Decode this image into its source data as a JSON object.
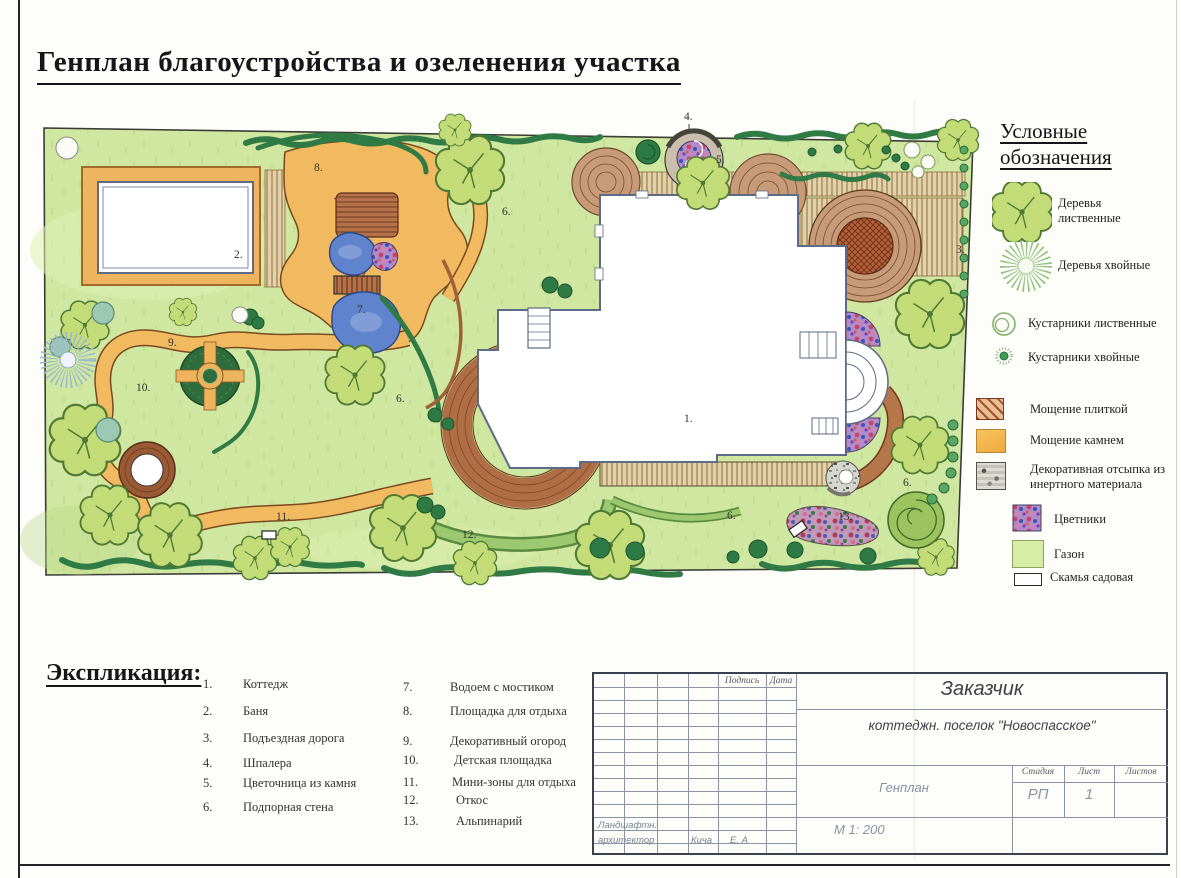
{
  "page": {
    "title": "Генплан благоустройства и озеленения участка"
  },
  "legend": {
    "heading_line1": "Условные",
    "heading_line2": "обозначения",
    "items": [
      {
        "icon": "deciduous-tree-icon",
        "label": "Деревья лиственные"
      },
      {
        "icon": "coniferous-tree-icon",
        "label": "Деревья хвойные"
      },
      {
        "icon": "deciduous-shrub-icon",
        "label": "Кустарники лиственные"
      },
      {
        "icon": "coniferous-shrub-icon",
        "label": "Кустарники хвойные"
      },
      {
        "icon": "tile-paving-swatch",
        "label": "Мощение плиткой"
      },
      {
        "icon": "stone-paving-swatch",
        "label": "Мощение камнем"
      },
      {
        "icon": "inert-fill-swatch",
        "label": "Декоративная отсыпка из инертного материала"
      },
      {
        "icon": "flowerbed-swatch",
        "label": "Цветники"
      },
      {
        "icon": "lawn-swatch",
        "label": "Газон"
      },
      {
        "icon": "garden-bench-icon",
        "label": "Скамья садовая"
      }
    ]
  },
  "explication": {
    "heading": "Экспликация:",
    "items": [
      {
        "num": "1.",
        "label": "Коттедж"
      },
      {
        "num": "2.",
        "label": "Баня"
      },
      {
        "num": "3.",
        "label": "Подъездная дорога"
      },
      {
        "num": "4.",
        "label": "Шпалера"
      },
      {
        "num": "5.",
        "label": "Цветочница из камня"
      },
      {
        "num": "6.",
        "label": "Подпорная стена"
      },
      {
        "num": "7.",
        "label": "Водоем с мостиком"
      },
      {
        "num": "8.",
        "label": "Площадка для отдыха"
      },
      {
        "num": "9.",
        "label": "Декоративный огород"
      },
      {
        "num": "10.",
        "label": "Детская площадка"
      },
      {
        "num": "11.",
        "label": "Мини-зоны для отдыха"
      },
      {
        "num": "12.",
        "label": "Откос"
      },
      {
        "num": "13.",
        "label": "Альпинарий"
      }
    ]
  },
  "stamp": {
    "signature_label": "Подпись",
    "date_label": "Дата",
    "client_label": "Заказчик",
    "project": "коттеджн. поселок \"Новоспасское\"",
    "drawing_title": "Генплан",
    "stage_label": "Стадия",
    "stage_value": "РП",
    "sheet_label": "Лист",
    "sheet_value": "1",
    "sheets_label": "Листов",
    "scale": "М 1: 200",
    "role_line1": "Ландшафтн.",
    "role_line2": "архитектор",
    "author_name": "Кича",
    "author_initials": "Е. А"
  },
  "plan": {
    "markers": [
      {
        "text": "1."
      },
      {
        "text": "2."
      },
      {
        "text": "3."
      },
      {
        "text": "4."
      },
      {
        "text": "5."
      },
      {
        "text": "6."
      },
      {
        "text": "6."
      },
      {
        "text": "6."
      },
      {
        "text": "6."
      },
      {
        "text": "7."
      },
      {
        "text": "8."
      },
      {
        "text": "9."
      },
      {
        "text": "10."
      },
      {
        "text": "11."
      },
      {
        "text": "12."
      },
      {
        "text": "13."
      }
    ]
  },
  "palette": {
    "lawn": "#cfe7a0",
    "stone_path": "#f2ba60",
    "tile_paving": "#c49270",
    "water": "#5f83cc",
    "foliage": "#c3dc78",
    "hedge": "#2f7a45",
    "flowerbed": "#b08cc8"
  }
}
